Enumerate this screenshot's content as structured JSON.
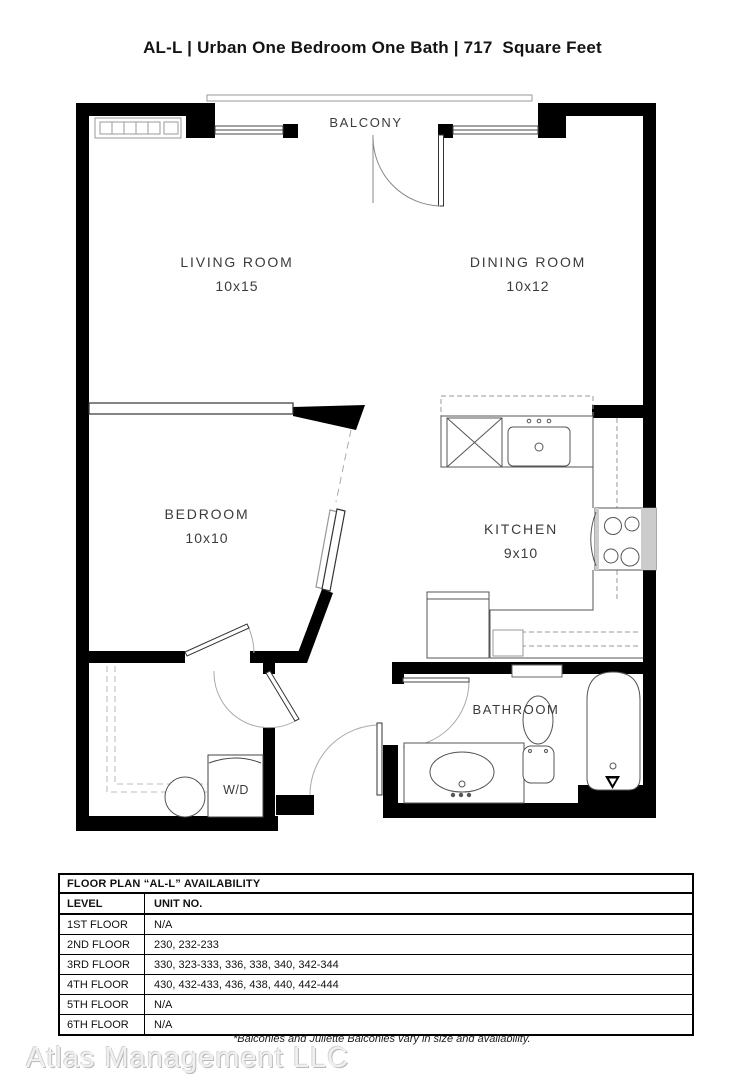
{
  "title": "AL-L | Urban One Bedroom One Bath | 717  Square Feet",
  "plan": {
    "balcony": "BALCONY",
    "living": {
      "name": "LIVING ROOM",
      "dims": "10x15"
    },
    "dining": {
      "name": "DINING ROOM",
      "dims": "10x12"
    },
    "bedroom": {
      "name": "BEDROOM",
      "dims": "10x10"
    },
    "kitchen": {
      "name": "KITCHEN",
      "dims": "9x10"
    },
    "bathroom": "BATHROOM",
    "wd": "W/D"
  },
  "table": {
    "title": "FLOOR PLAN “AL-L” AVAILABILITY",
    "columns": {
      "level": "LEVEL",
      "unit": "UNIT NO."
    },
    "rows": [
      {
        "level": "1ST FLOOR",
        "units": "N/A"
      },
      {
        "level": "2ND FLOOR",
        "units": "230, 232-233"
      },
      {
        "level": "3RD FLOOR",
        "units": "330, 323-333, 336, 338, 340, 342-344"
      },
      {
        "level": "4TH FLOOR",
        "units": "430, 432-433, 436, 438, 440, 442-444"
      },
      {
        "level": "5TH FLOOR",
        "units": "N/A"
      },
      {
        "level": "6TH FLOOR",
        "units": "N/A"
      }
    ]
  },
  "footer": {
    "watermark": "Atlas Management LLC",
    "note": "*Balconies and Juliette Balconies vary in size and availability."
  },
  "colors": {
    "wall": "#000000",
    "fixture_line": "#555555",
    "text": "#3b3b3b"
  }
}
